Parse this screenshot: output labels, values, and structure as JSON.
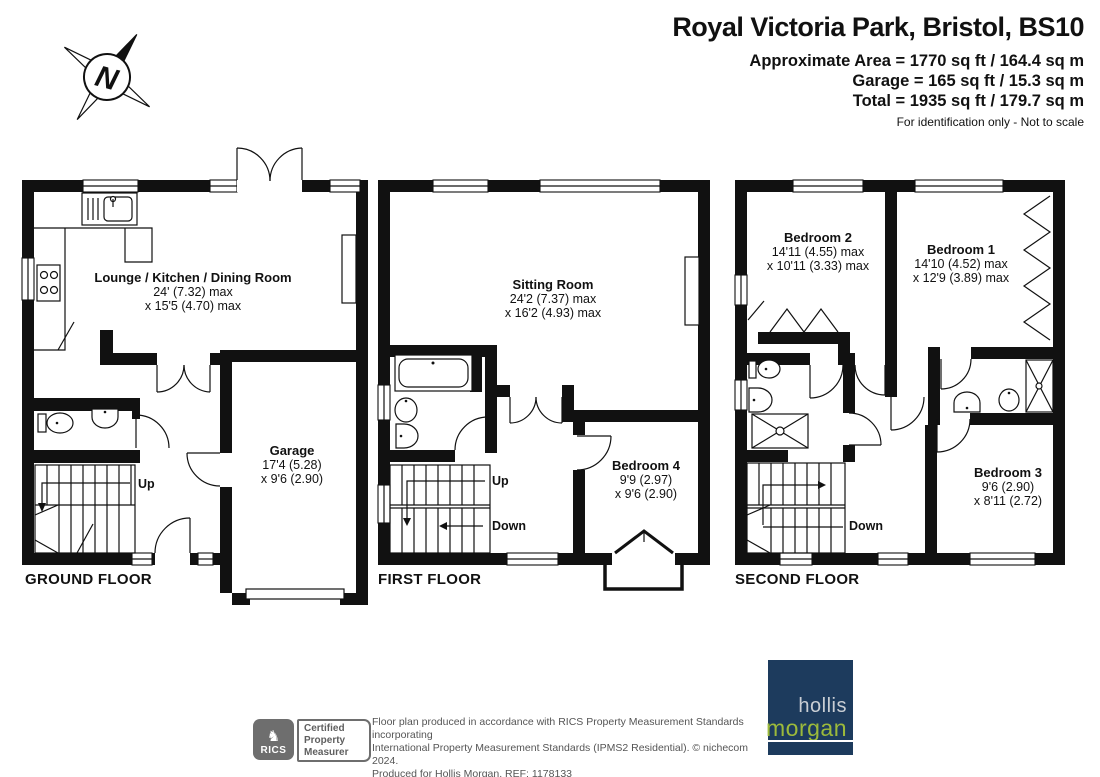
{
  "header": {
    "title": "Royal Victoria Park, Bristol, BS10",
    "area_line1": "Approximate Area = 1770 sq ft / 164.4 sq m",
    "area_line2": "Garage = 165 sq ft / 15.3 sq m",
    "area_line3": "Total = 1935 sq ft / 179.7 sq m",
    "note": "For identification only - Not to scale"
  },
  "compass": {
    "north_label": "N"
  },
  "floors": {
    "ground": {
      "label": "GROUND FLOOR",
      "up": "Up",
      "lounge": {
        "name": "Lounge / Kitchen / Dining Room",
        "d1": "24' (7.32) max",
        "d2": "x 15'5 (4.70) max"
      },
      "garage": {
        "name": "Garage",
        "d1": "17'4 (5.28)",
        "d2": "x 9'6 (2.90)"
      }
    },
    "first": {
      "label": "FIRST FLOOR",
      "up": "Up",
      "down": "Down",
      "sitting": {
        "name": "Sitting Room",
        "d1": "24'2 (7.37) max",
        "d2": "x 16'2 (4.93) max"
      },
      "bedroom4": {
        "name": "Bedroom 4",
        "d1": "9'9 (2.97)",
        "d2": "x 9'6 (2.90)"
      }
    },
    "second": {
      "label": "SECOND FLOOR",
      "down": "Down",
      "bedroom2": {
        "name": "Bedroom 2",
        "d1": "14'11 (4.55) max",
        "d2": "x 10'11 (3.33) max"
      },
      "bedroom1": {
        "name": "Bedroom 1",
        "d1": "14'10 (4.52) max",
        "d2": "x 12'9 (3.89) max"
      },
      "bedroom3": {
        "name": "Bedroom 3",
        "d1": "9'6 (2.90)",
        "d2": "x 8'11 (2.72)"
      }
    }
  },
  "footer": {
    "rics_icon": "♞",
    "rics_label": "RICS",
    "badge_line1": "Certified",
    "badge_line2": "Property",
    "badge_line3": "Measurer",
    "disclaimer_line1": "Floor plan produced in accordance with RICS Property Measurement Standards incorporating",
    "disclaimer_line2": "International Property Measurement Standards (IPMS2 Residential).   © nichecom 2024.",
    "disclaimer_line3": "Produced for Hollis Morgan.   REF:  1178133",
    "logo_line1": "hollis",
    "logo_line2": "morgan"
  },
  "colors": {
    "wall": "#111111",
    "logo_navy": "#1d3b5d",
    "logo_green": "#9cba3b",
    "logo_text_gray": "#c9ced4",
    "rics_gray": "#6e6e6e"
  }
}
